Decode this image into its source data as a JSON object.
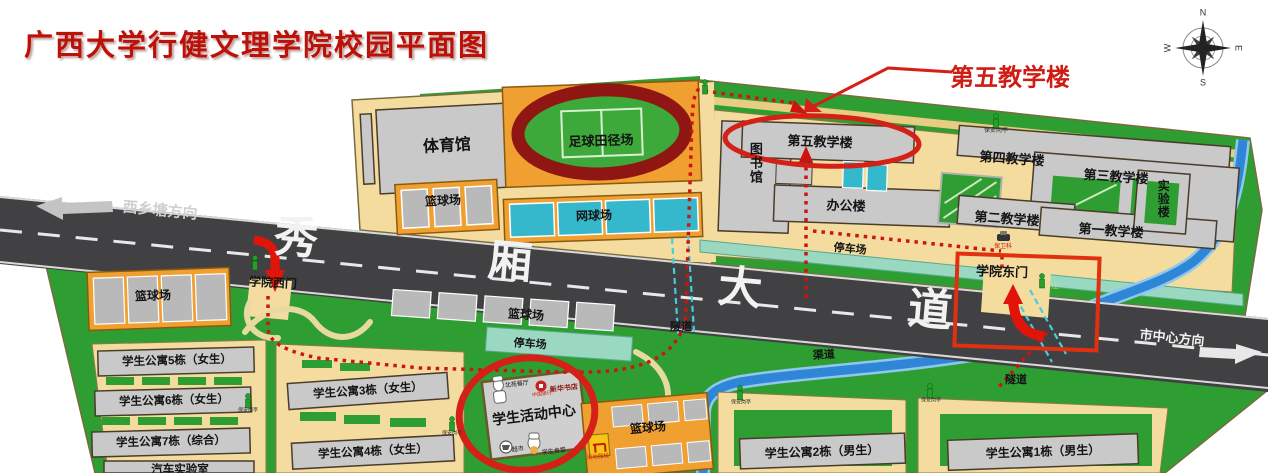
{
  "title": "广西大学行健文理学院校园平面图",
  "annotations": {
    "callout_teach5": "第五教学楼"
  },
  "compass": {
    "n": "N",
    "e": "E",
    "s": "S",
    "w": "W"
  },
  "road": {
    "chars": [
      "秀",
      "厢",
      "大",
      "道"
    ],
    "west_direction": "西乡塘方向",
    "east_direction": "市中心方向"
  },
  "gates": {
    "west": "学院西门",
    "east": "学院东门",
    "security_section": "保卫科",
    "gatekeeper": "门卫"
  },
  "north": {
    "gym": "体育馆",
    "stadium": "足球田径场",
    "basketball": "篮球场",
    "tennis": "网球场",
    "library": "图书馆",
    "teach5": "第五教学楼",
    "office": "办公楼",
    "teach4": "第四教学楼",
    "teach3": "第三教学楼",
    "teach2": "第二教学楼",
    "teach1": "第一教学楼",
    "lab": "实验楼",
    "parking": "停车场",
    "guard_booth": "保安岗亭"
  },
  "south": {
    "basketball_sw": "篮球场",
    "basketball_mid": "篮球场",
    "basketball_se": "篮球场",
    "parking": "停车场",
    "tunnel_west": "隧道",
    "tunnel_east": "隧道",
    "canal": "渠道",
    "dorm5": "学生公寓5栋（女生）",
    "dorm6": "学生公寓6栋（女生）",
    "dorm7": "学生公寓7栋（综合）",
    "auto_lab": "汽车实验室",
    "dorm3": "学生公寓3栋（女生）",
    "dorm4": "学生公寓4栋（女生）",
    "dorm2": "学生公寓2栋（男生）",
    "dorm1": "学生公寓1栋（男生）",
    "equipment": "运动器械",
    "guard_booth": "保安岗亭",
    "activity": {
      "name": "学生活动中心",
      "canteen_north": "北苑餐厅",
      "bank": "中国银行",
      "bookstore": "新华书店",
      "supermarket": "超市",
      "canteen_student": "学生食堂"
    }
  },
  "colors": {
    "accent_red": "#d42016",
    "campus_green": "#2f9e32",
    "parcel_tan": "#f3dc9e",
    "road_dark": "#414144",
    "water_blue": "#2f86d6",
    "court_teal": "#35b8cc",
    "building_gray": "#c9c9c9",
    "track_red": "#8f1612"
  }
}
